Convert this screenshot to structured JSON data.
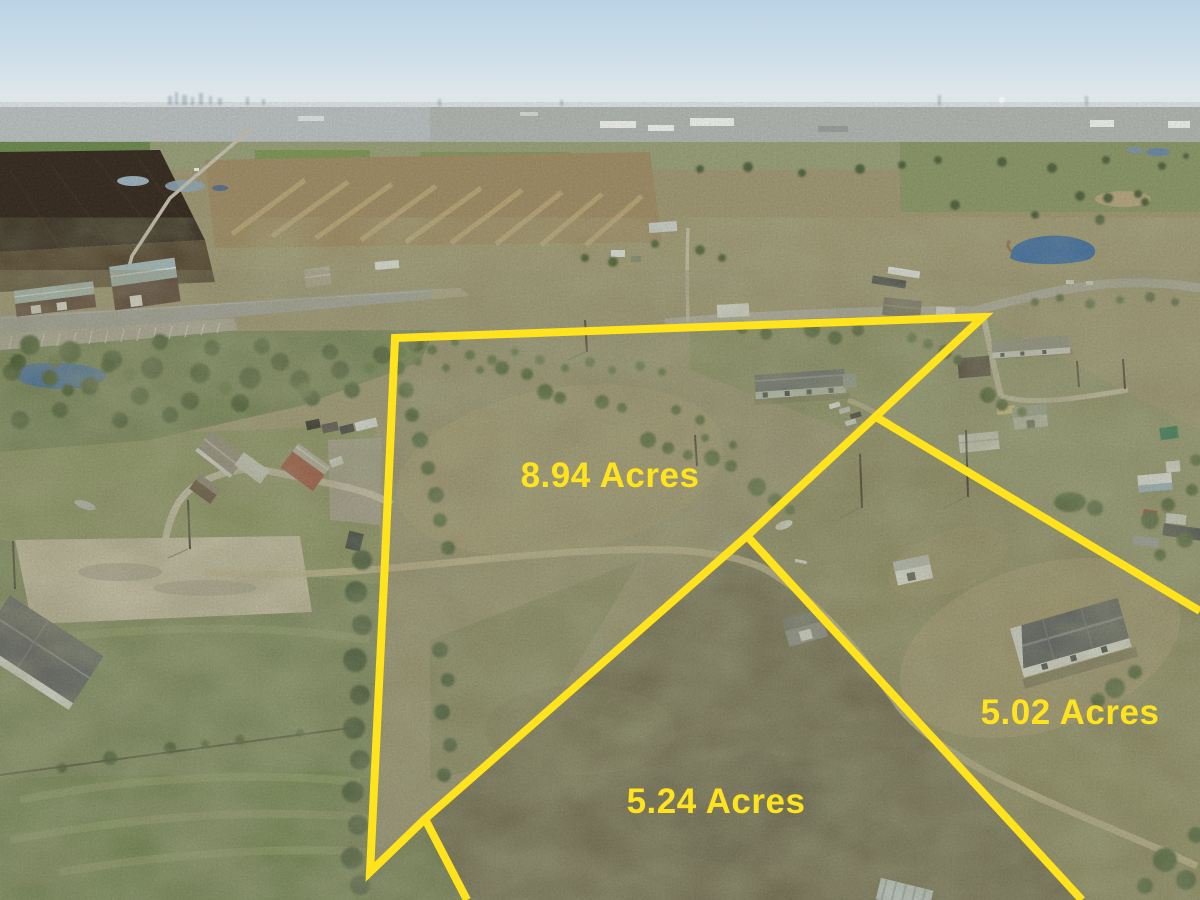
{
  "photo": {
    "kind": "aerial-drone-photo",
    "description": "Aerial view of rural land parcels outlined in yellow, with houses, barns, ponds, roads and a distant city skyline on the horizon",
    "overlay_color": "#ffe31c"
  },
  "parcels": [
    {
      "label": "8.94 Acres"
    },
    {
      "label": "5.24 Acres"
    },
    {
      "label": "5.02 Acres"
    }
  ]
}
